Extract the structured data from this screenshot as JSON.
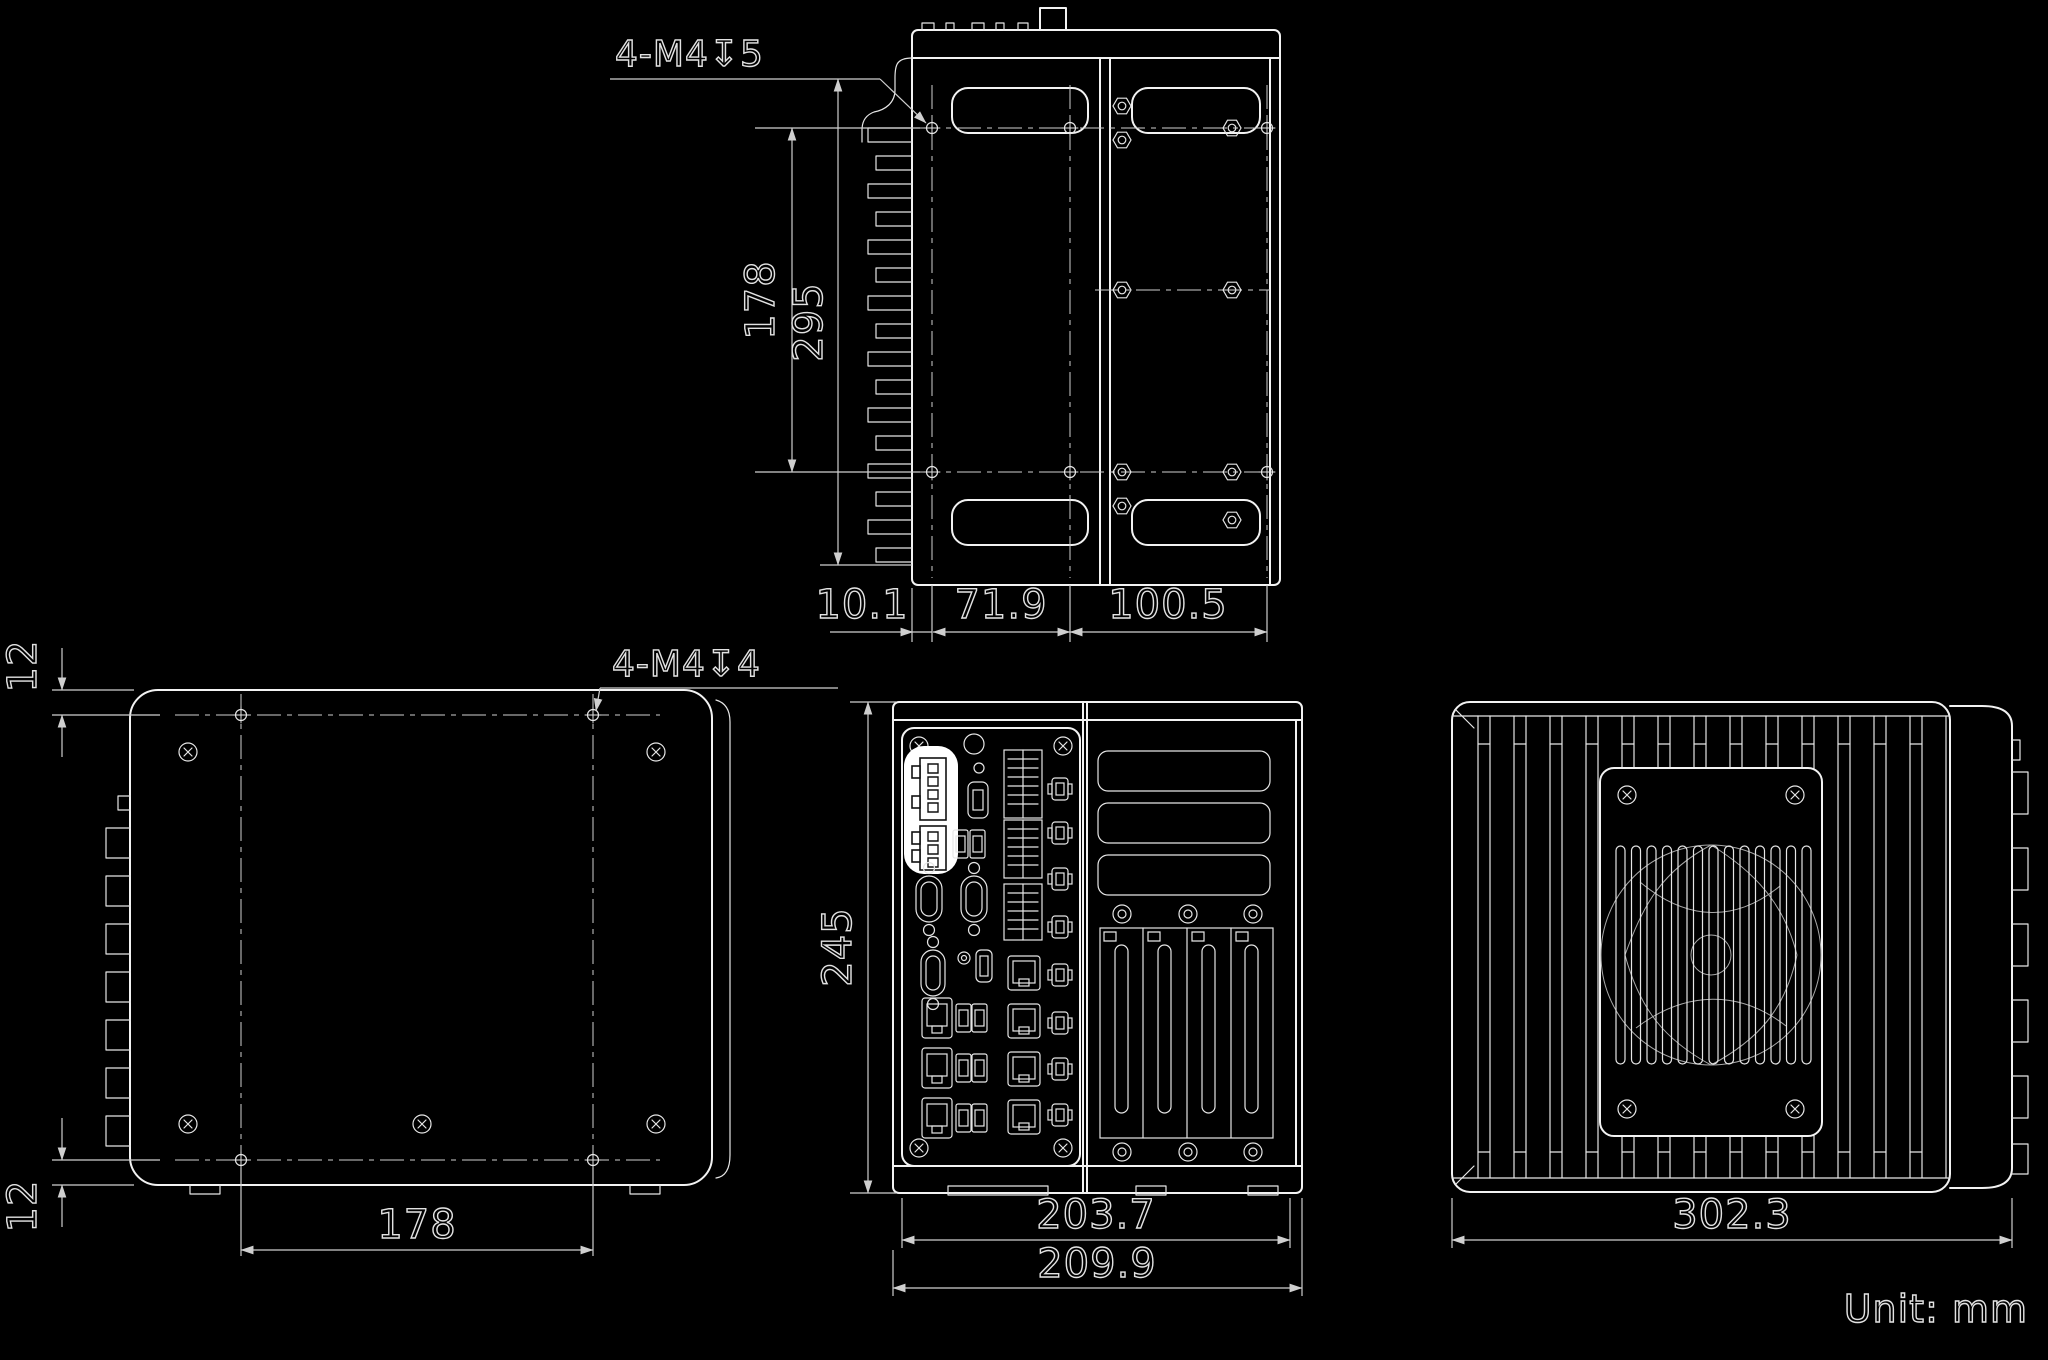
{
  "note": {
    "unit": "Unit: mm"
  },
  "views": {
    "side": {
      "callout": "4-M4↧5",
      "dims": {
        "hole_span_height": "178",
        "outer_span_height": "295",
        "depth_left": "10.1",
        "depth_mid": "71.9",
        "depth_right": "100.5"
      }
    },
    "bottom": {
      "callout": "4-M4↧4",
      "dims": {
        "top_offset": "12",
        "bottom_offset": "12",
        "hole_spacing": "178"
      }
    },
    "front": {
      "dims": {
        "height": "245",
        "width_inner": "203.7",
        "width_overall": "209.9"
      }
    },
    "heatsink": {
      "dims": {
        "width_overall": "302.3"
      }
    }
  },
  "colors": {
    "background": "#000000",
    "object_line": "#f2f2f2",
    "dimension_line": "#cfcfcf",
    "text": "#e2e2e2",
    "highlight": "#ffffff"
  }
}
